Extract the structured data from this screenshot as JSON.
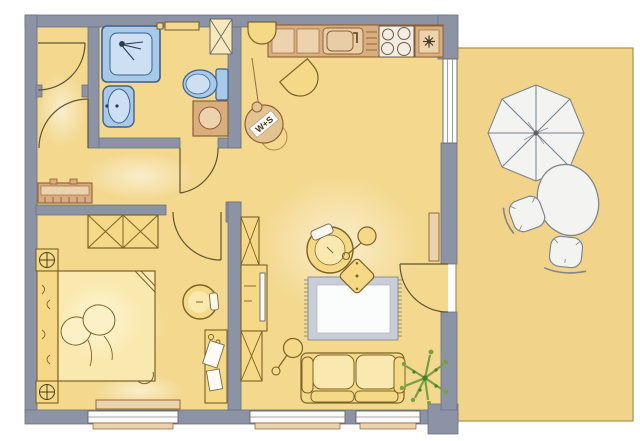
{
  "page": {
    "type": "architectural-floor-plan",
    "background": "#ffffff"
  },
  "stamp": {
    "label": "W+S"
  },
  "colors": {
    "floor": "#F3D88E",
    "terrace_floor": "#F1D489",
    "wall": "#8C93A4",
    "wall_stroke": "#6B7280",
    "fixture_blue": "#A9C9E9",
    "fixture_blue_light": "#CDE0F3",
    "fixture_blue_dark": "#3A618F",
    "wood": "#D9AE7E",
    "wood_light": "#ECD3AE",
    "wood_stroke": "#8E5F33",
    "furniture_yellow": "#F5D987",
    "furniture_yellow_light": "#FAE9AE",
    "furniture_stroke": "#7C6226",
    "white_furniture": "#F3F4F1",
    "white_furniture_stroke": "#81868C",
    "rug_border": "#C9CDD6",
    "rug_inner": "#FBFCFC",
    "plant_green": "#76A046",
    "plant_green_dark": "#4C7A2C",
    "line_dark": "#5F5534",
    "appliance_white": "#F2EEE6"
  }
}
